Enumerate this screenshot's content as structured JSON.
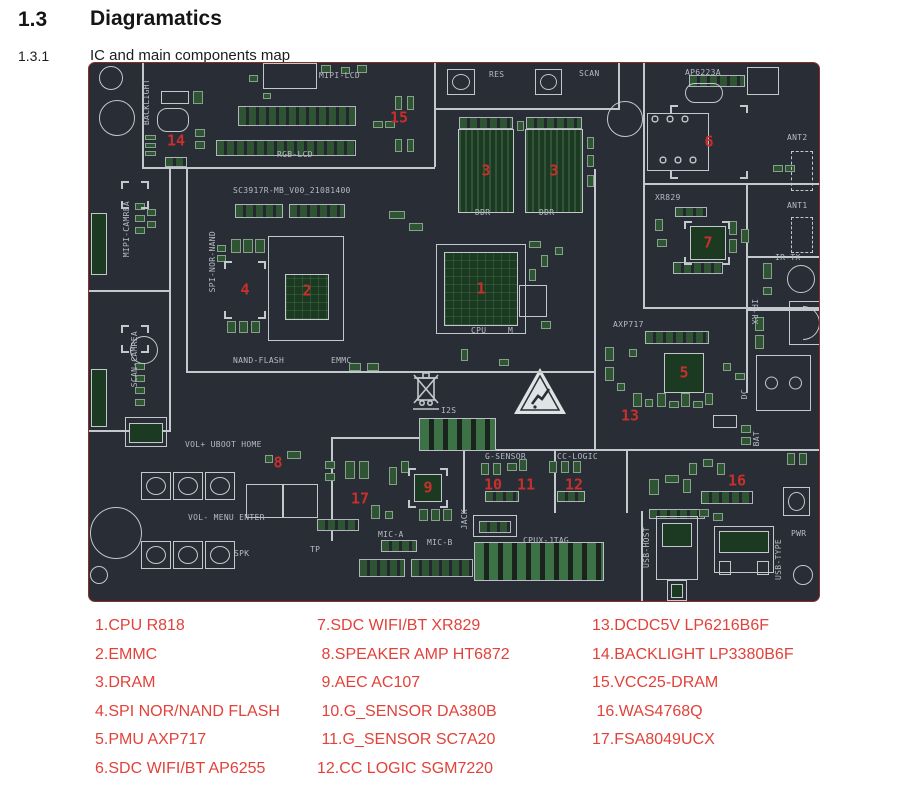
{
  "page": {
    "section_number": "1.3",
    "section_title": "Diagramatics",
    "subsection_number": "1.3.1",
    "subsection_title": "IC and main components map"
  },
  "colors": {
    "board_bg": "#282d36",
    "board_outline": "#8c2d26",
    "silkscreen": "#b6bcc2",
    "pad_green": "#2e5433",
    "chip_green": "#1c3a21",
    "marker_red": "#c9302c",
    "legend_red": "#e2423a"
  },
  "board": {
    "name_label": "SC3917R-MB_V00_21081400",
    "lines": [
      [
        53,
        0,
        2,
        106
      ],
      [
        53,
        104,
        29,
        2
      ],
      [
        80,
        104,
        2,
        264
      ],
      [
        0,
        227,
        80,
        2
      ],
      [
        0,
        367,
        82,
        2
      ],
      [
        80,
        104,
        266,
        2
      ],
      [
        97,
        106,
        2,
        204
      ],
      [
        97,
        308,
        410,
        2
      ],
      [
        345,
        0,
        2,
        104
      ],
      [
        347,
        45,
        184,
        2
      ],
      [
        529,
        0,
        2,
        45
      ],
      [
        554,
        0,
        2,
        246
      ],
      [
        556,
        120,
        174,
        2
      ],
      [
        556,
        244,
        174,
        2
      ],
      [
        505,
        106,
        2,
        282
      ],
      [
        374,
        386,
        356,
        2
      ],
      [
        374,
        388,
        2,
        62
      ],
      [
        465,
        388,
        2,
        62
      ],
      [
        537,
        388,
        2,
        62
      ],
      [
        242,
        374,
        2,
        104
      ],
      [
        244,
        374,
        130,
        2
      ],
      [
        552,
        448,
        2,
        90
      ],
      [
        657,
        120,
        2,
        210
      ],
      [
        659,
        193,
        71,
        2
      ],
      [
        659,
        246,
        71,
        2
      ]
    ],
    "strips": [
      [
        149,
        43,
        118,
        20
      ],
      [
        127,
        77,
        140,
        16
      ],
      [
        146,
        141,
        48,
        14
      ],
      [
        200,
        141,
        56,
        14
      ],
      [
        370,
        54,
        54,
        12
      ],
      [
        437,
        54,
        56,
        12
      ],
      [
        584,
        199,
        50,
        12
      ],
      [
        586,
        144,
        32,
        10
      ],
      [
        556,
        268,
        64,
        13
      ],
      [
        612,
        428,
        52,
        13
      ],
      [
        396,
        428,
        34,
        11
      ],
      [
        468,
        428,
        28,
        11
      ],
      [
        292,
        477,
        36,
        12
      ],
      [
        228,
        456,
        42,
        12
      ],
      [
        270,
        496,
        46,
        18
      ],
      [
        322,
        496,
        62,
        18
      ],
      [
        390,
        458,
        32,
        12
      ],
      [
        560,
        446,
        56,
        10
      ],
      [
        600,
        12,
        56,
        12
      ],
      [
        76,
        94,
        22,
        10
      ]
    ],
    "pads": [
      [
        232,
        2,
        10,
        8
      ],
      [
        252,
        4,
        9,
        7
      ],
      [
        268,
        2,
        10,
        8
      ],
      [
        306,
        33,
        7,
        14
      ],
      [
        318,
        33,
        7,
        14
      ],
      [
        306,
        76,
        7,
        13
      ],
      [
        318,
        76,
        7,
        13
      ],
      [
        284,
        58,
        10,
        7
      ],
      [
        296,
        58,
        10,
        7
      ],
      [
        160,
        12,
        9,
        7
      ],
      [
        174,
        30,
        8,
        6
      ],
      [
        56,
        72,
        11,
        5
      ],
      [
        56,
        80,
        11,
        5
      ],
      [
        56,
        88,
        11,
        5
      ],
      [
        104,
        28,
        10,
        13
      ],
      [
        106,
        66,
        10,
        8
      ],
      [
        106,
        78,
        10,
        8
      ],
      [
        128,
        182,
        9,
        7
      ],
      [
        128,
        192,
        9,
        7
      ],
      [
        142,
        176,
        10,
        14
      ],
      [
        154,
        176,
        10,
        14
      ],
      [
        166,
        176,
        10,
        14
      ],
      [
        138,
        258,
        9,
        12
      ],
      [
        150,
        258,
        9,
        12
      ],
      [
        162,
        258,
        9,
        12
      ],
      [
        260,
        300,
        12,
        8
      ],
      [
        278,
        300,
        12,
        8
      ],
      [
        300,
        148,
        16,
        8
      ],
      [
        320,
        160,
        14,
        8
      ],
      [
        440,
        178,
        12,
        7
      ],
      [
        452,
        192,
        7,
        12
      ],
      [
        466,
        184,
        8,
        8
      ],
      [
        440,
        206,
        7,
        12
      ],
      [
        372,
        286,
        7,
        12
      ],
      [
        410,
        296,
        10,
        7
      ],
      [
        452,
        258,
        10,
        8
      ],
      [
        498,
        74,
        7,
        12
      ],
      [
        498,
        92,
        7,
        12
      ],
      [
        498,
        112,
        7,
        12
      ],
      [
        428,
        58,
        7,
        10
      ],
      [
        566,
        156,
        8,
        12
      ],
      [
        640,
        158,
        8,
        14
      ],
      [
        652,
        166,
        8,
        14
      ],
      [
        640,
        176,
        8,
        14
      ],
      [
        568,
        176,
        10,
        8
      ],
      [
        684,
        102,
        10,
        7
      ],
      [
        696,
        102,
        10,
        7
      ],
      [
        516,
        284,
        9,
        14
      ],
      [
        516,
        304,
        9,
        14
      ],
      [
        528,
        320,
        8,
        8
      ],
      [
        540,
        286,
        8,
        8
      ],
      [
        544,
        330,
        9,
        14
      ],
      [
        556,
        336,
        8,
        8
      ],
      [
        568,
        330,
        9,
        14
      ],
      [
        580,
        338,
        10,
        7
      ],
      [
        592,
        330,
        9,
        14
      ],
      [
        604,
        338,
        10,
        7
      ],
      [
        616,
        330,
        8,
        12
      ],
      [
        634,
        300,
        8,
        8
      ],
      [
        646,
        310,
        10,
        7
      ],
      [
        674,
        200,
        9,
        16
      ],
      [
        674,
        224,
        9,
        8
      ],
      [
        666,
        254,
        9,
        14
      ],
      [
        666,
        272,
        9,
        14
      ],
      [
        392,
        400,
        8,
        12
      ],
      [
        404,
        400,
        8,
        12
      ],
      [
        418,
        400,
        10,
        8
      ],
      [
        430,
        396,
        8,
        12
      ],
      [
        460,
        398,
        8,
        12
      ],
      [
        472,
        398,
        8,
        12
      ],
      [
        484,
        398,
        8,
        12
      ],
      [
        300,
        404,
        8,
        18
      ],
      [
        312,
        398,
        8,
        12
      ],
      [
        256,
        398,
        10,
        18
      ],
      [
        270,
        398,
        10,
        18
      ],
      [
        330,
        446,
        9,
        12
      ],
      [
        342,
        446,
        9,
        12
      ],
      [
        354,
        446,
        9,
        12
      ],
      [
        282,
        442,
        9,
        14
      ],
      [
        296,
        448,
        8,
        8
      ],
      [
        236,
        398,
        10,
        8
      ],
      [
        236,
        410,
        10,
        8
      ],
      [
        198,
        388,
        14,
        8
      ],
      [
        176,
        392,
        8,
        8
      ],
      [
        600,
        400,
        8,
        12
      ],
      [
        614,
        396,
        10,
        8
      ],
      [
        628,
        400,
        8,
        12
      ],
      [
        610,
        446,
        10,
        8
      ],
      [
        624,
        450,
        10,
        8
      ],
      [
        698,
        390,
        8,
        12
      ],
      [
        710,
        390,
        8,
        12
      ],
      [
        560,
        416,
        10,
        16
      ],
      [
        576,
        412,
        14,
        8
      ],
      [
        594,
        416,
        8,
        14
      ],
      [
        652,
        362,
        10,
        8
      ],
      [
        652,
        374,
        10,
        8
      ],
      [
        46,
        140,
        10,
        7
      ],
      [
        46,
        152,
        10,
        7
      ],
      [
        46,
        164,
        10,
        7
      ],
      [
        58,
        146,
        9,
        7
      ],
      [
        58,
        158,
        9,
        7
      ],
      [
        46,
        300,
        10,
        7
      ],
      [
        46,
        312,
        10,
        7
      ],
      [
        46,
        324,
        10,
        7
      ],
      [
        46,
        336,
        10,
        7
      ]
    ],
    "blocks": [
      [
        330,
        355,
        77,
        33
      ],
      [
        385,
        479,
        130,
        39
      ]
    ],
    "chips": [
      [
        355,
        189,
        74,
        74,
        "grid"
      ],
      [
        196,
        211,
        44,
        46,
        "grid"
      ],
      [
        369,
        66,
        56,
        84,
        "stripes"
      ],
      [
        436,
        66,
        58,
        84,
        "stripes"
      ],
      [
        589,
        50,
        62,
        58,
        "dots"
      ],
      [
        601,
        163,
        36,
        34,
        ""
      ],
      [
        575,
        290,
        40,
        40,
        ""
      ],
      [
        325,
        411,
        28,
        28,
        ""
      ],
      [
        2,
        150,
        16,
        62,
        ""
      ],
      [
        2,
        306,
        16,
        58,
        ""
      ],
      [
        40,
        360,
        34,
        20,
        ""
      ],
      [
        573,
        460,
        30,
        24,
        ""
      ],
      [
        582,
        521,
        12,
        14,
        ""
      ],
      [
        630,
        468,
        50,
        22,
        ""
      ]
    ],
    "outlines": [
      [
        347,
        181,
        90,
        90,
        ""
      ],
      [
        179,
        173,
        76,
        105,
        ""
      ],
      [
        174,
        0,
        54,
        26,
        ""
      ],
      [
        72,
        28,
        28,
        13,
        ""
      ],
      [
        68,
        45,
        32,
        24,
        "r"
      ],
      [
        658,
        4,
        32,
        28,
        ""
      ],
      [
        596,
        20,
        38,
        20,
        "r"
      ],
      [
        702,
        88,
        22,
        40,
        "d"
      ],
      [
        702,
        154,
        22,
        36,
        "d"
      ],
      [
        667,
        292,
        55,
        56,
        "c2"
      ],
      [
        700,
        238,
        34,
        44,
        "dome"
      ],
      [
        157,
        421,
        72,
        34,
        "split"
      ],
      [
        384,
        452,
        44,
        22,
        ""
      ],
      [
        567,
        453,
        42,
        64,
        ""
      ],
      [
        578,
        517,
        20,
        21,
        ""
      ],
      [
        625,
        463,
        60,
        47,
        ""
      ],
      [
        630,
        498,
        12,
        14,
        ""
      ],
      [
        668,
        498,
        12,
        14,
        ""
      ],
      [
        430,
        222,
        28,
        32,
        ""
      ],
      [
        36,
        354,
        42,
        30,
        ""
      ],
      [
        624,
        352,
        24,
        13,
        ""
      ]
    ],
    "brackets": [
      [
        135,
        198,
        42,
        58
      ],
      [
        595,
        158,
        46,
        44
      ],
      [
        581,
        42,
        78,
        74
      ],
      [
        319,
        405,
        40,
        40
      ],
      [
        32,
        118,
        28,
        28
      ],
      [
        32,
        262,
        28,
        28
      ]
    ],
    "circles": [
      [
        22,
        15,
        12
      ],
      [
        28,
        55,
        18
      ],
      [
        536,
        56,
        18
      ],
      [
        27,
        470,
        26
      ],
      [
        10,
        512,
        9
      ],
      [
        714,
        512,
        10
      ],
      [
        712,
        216,
        14
      ],
      [
        55,
        287,
        14
      ]
    ],
    "buttons": [
      [
        358,
        6,
        28,
        26
      ],
      [
        446,
        6,
        27,
        26
      ],
      [
        52,
        409,
        30,
        28
      ],
      [
        84,
        409,
        30,
        28
      ],
      [
        116,
        409,
        30,
        28
      ],
      [
        52,
        478,
        30,
        28
      ],
      [
        84,
        478,
        30,
        28
      ],
      [
        116,
        478,
        30,
        28
      ],
      [
        694,
        424,
        27,
        29
      ]
    ],
    "markers": [
      [
        "1",
        392,
        226
      ],
      [
        "2",
        218,
        228
      ],
      [
        "3",
        397,
        108
      ],
      [
        "3",
        465,
        108
      ],
      [
        "4",
        156,
        227
      ],
      [
        "5",
        595,
        310
      ],
      [
        "6",
        620,
        79
      ],
      [
        "7",
        619,
        180
      ],
      [
        "8",
        189,
        400
      ],
      [
        "9",
        339,
        425
      ],
      [
        "10",
        404,
        422
      ],
      [
        "11",
        437,
        422
      ],
      [
        "12",
        485,
        422
      ],
      [
        "13",
        541,
        353
      ],
      [
        "14",
        87,
        78
      ],
      [
        "15",
        310,
        55
      ],
      [
        "16",
        648,
        418
      ],
      [
        "17",
        271,
        436
      ]
    ],
    "labels": [
      [
        "MIPI-LCD",
        230,
        9,
        0
      ],
      [
        "RGB-LCD",
        188,
        88,
        0
      ],
      [
        "SC3917R-MB_V00_21081400",
        144,
        124,
        0
      ],
      [
        "RES",
        400,
        8,
        0
      ],
      [
        "SCAN",
        490,
        7,
        0
      ],
      [
        "AP6223A",
        596,
        6,
        0
      ],
      [
        "ANT2",
        698,
        71,
        0
      ],
      [
        "ANT1",
        698,
        139,
        0
      ],
      [
        "XR829",
        566,
        131,
        0
      ],
      [
        "IR-TX",
        686,
        191,
        0
      ],
      [
        "NAND-FLASH",
        144,
        294,
        0
      ],
      [
        "EMMC",
        242,
        294,
        0
      ],
      [
        "DDR",
        386,
        146,
        0
      ],
      [
        "DDR",
        450,
        146,
        0
      ],
      [
        "CPU",
        382,
        264,
        0
      ],
      [
        "M",
        419,
        264,
        0
      ],
      [
        "AXP717",
        524,
        258,
        0
      ],
      [
        "I2S",
        352,
        344,
        0
      ],
      [
        "G-SENSOR",
        396,
        390,
        0
      ],
      [
        "CC-LOGIC",
        468,
        390,
        0
      ],
      [
        "VOL+ UBOOT HOME",
        96,
        378,
        0
      ],
      [
        "VOL- MENU ENTER",
        99,
        451,
        0
      ],
      [
        "SPK",
        145,
        487,
        0
      ],
      [
        "TP",
        221,
        483,
        0
      ],
      [
        "MIC-A",
        289,
        468,
        0
      ],
      [
        "MIC-B",
        338,
        476,
        0
      ],
      [
        "CPUX-JTAG",
        434,
        474,
        0
      ],
      [
        "PWR",
        702,
        467,
        0
      ],
      [
        "BACKLIGHT",
        54,
        16,
        1
      ],
      [
        "MIPI-CAMREA",
        34,
        138,
        1
      ],
      [
        "SCAN-CAMREA",
        42,
        268,
        1
      ],
      [
        "SPI-NOR-NAND",
        120,
        168,
        1
      ],
      [
        "IR-RX",
        660,
        236,
        2
      ],
      [
        "JACK",
        372,
        446,
        1
      ],
      [
        "USB-HOST",
        554,
        464,
        1
      ],
      [
        "USB-TYPE",
        686,
        476,
        1
      ],
      [
        "BAT",
        664,
        368,
        1
      ],
      [
        "DC",
        652,
        326,
        1
      ]
    ]
  },
  "legend": {
    "columns": [
      {
        "items": [
          "1.CPU R818",
          "2.EMMC",
          "3.DRAM",
          "4.SPI NOR/NAND FLASH",
          "5.PMU AXP717",
          "6.SDC WIFI/BT AP6255"
        ]
      },
      {
        "items": [
          "7.SDC WIFI/BT XR829",
          " 8.SPEAKER AMP HT6872",
          " 9.AEC AC107",
          " 10.G_SENSOR DA380B",
          " 11.G_SENSOR SC7A20",
          "12.CC LOGIC SGM7220"
        ]
      },
      {
        "items": [
          "13.DCDC5V LP6216B6F",
          "14.BACKLIGHT LP3380B6F",
          "15.VCC25-DRAM",
          " 16.WAS4768Q",
          "17.FSA8049UCX"
        ]
      }
    ]
  }
}
